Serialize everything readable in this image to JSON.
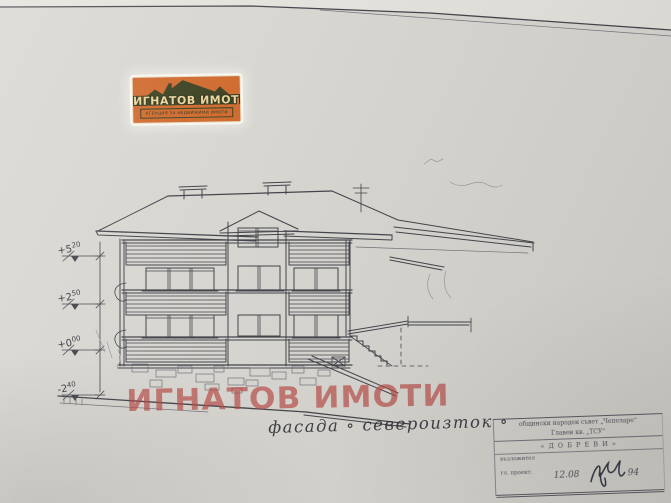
{
  "colors": {
    "paper": "#d8d6d1",
    "paper_top": "#e5e3dd",
    "ink": "#45454c",
    "ink_faint": "#74747c",
    "pencil": "#9b9ba1",
    "red": "#b84a44",
    "logo_bg": "#cf6a2e",
    "logo_roof": "#3c4222",
    "logo_text": "#ecd39c"
  },
  "logo": {
    "title": "ИГНАТОВ ИМОТИ",
    "subtitle": "АГЕНЦИЯ ЗА НЕДВИЖИМИ ИМОТИ"
  },
  "watermark": {
    "text": "ИГНАТОВ ИМОТИ"
  },
  "caption": {
    "text": "фасада ∘ североизток ∘"
  },
  "elevation_marks": [
    {
      "label": "+5.20",
      "main": "+5",
      "sup": "20"
    },
    {
      "label": "+2.50",
      "main": "+2",
      "sup": "50"
    },
    {
      "label": "+0.00",
      "main": "+0",
      "sup": "00"
    },
    {
      "label": "-2.40",
      "main": "-2",
      "sup": "40"
    }
  ],
  "title_block": {
    "line1": "общински народен съвет „Чепеларе“",
    "line2": "Главен кв. „ТСУ“",
    "line3": "« Д О Б Р Е В И »",
    "line4": "възложител",
    "line5": "гл. проект.",
    "date": "12.08",
    "year": "94"
  }
}
